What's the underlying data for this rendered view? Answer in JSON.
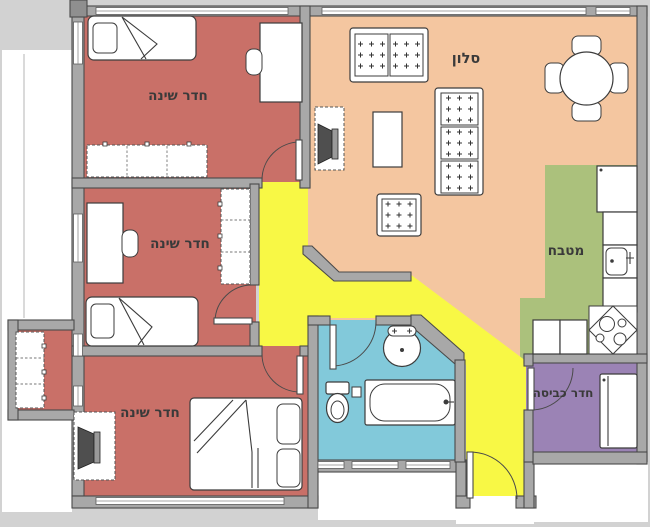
{
  "title": "Apartment floor plan",
  "rooms": {
    "bedroom1": {
      "label": "חדר שינה"
    },
    "bedroom2": {
      "label": "חדר שינה"
    },
    "bedroom3": {
      "label": "חדר שינה"
    },
    "living": {
      "label": "סלון"
    },
    "kitchen": {
      "label": "מטבח"
    },
    "laundry": {
      "label": "חדר כביסה"
    }
  },
  "colors": {
    "background": "#d2d2d2",
    "outside": "#ffffff",
    "bedroom_floor": "#c97068",
    "living_floor": "#f4c6a0",
    "kitchen_floor": "#abc17c",
    "bathroom_floor": "#82c9da",
    "laundry_floor": "#9b83b5",
    "hallway_floor": "#f8f845",
    "wall": "#a8a8a8",
    "wall_outline": "#4a4a4a",
    "label_text": "#3a3a3a"
  }
}
